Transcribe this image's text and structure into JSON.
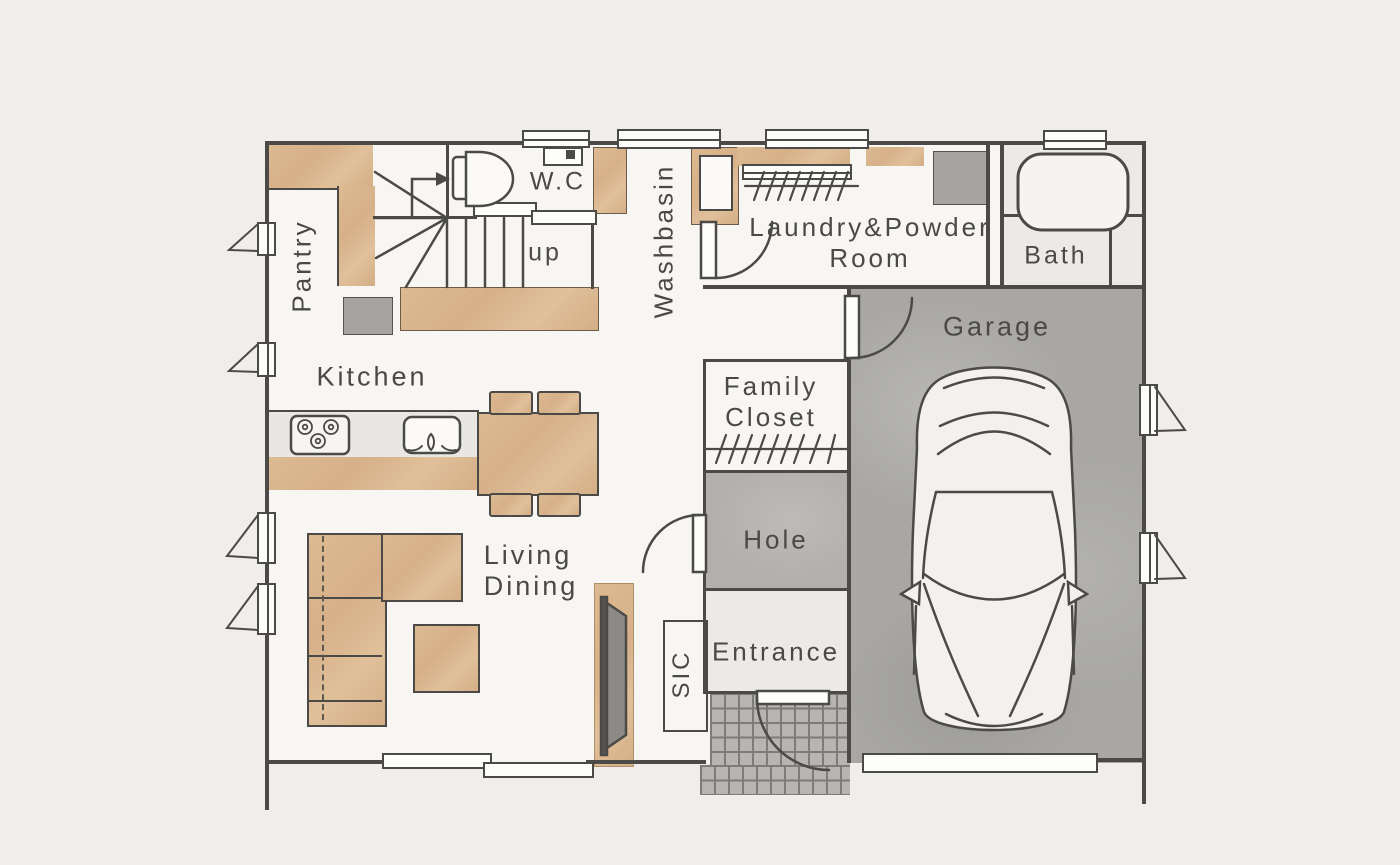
{
  "meta": {
    "type": "architectural-floor-plan",
    "style": "japanese-house-first-floor"
  },
  "labels": {
    "pantry": "Pantry",
    "wc": "W.C",
    "up": "up",
    "washbasin": "Washbasin",
    "laundry_line1": "Laundry&Powder",
    "laundry_line2": "Room",
    "bath": "Bath",
    "kitchen": "Kitchen",
    "garage": "Garage",
    "family_line1": "Family",
    "family_line2": "Closet",
    "hole": "Hole",
    "living_line1": "Living",
    "living_line2": "Dining",
    "sic": "SIC",
    "entrance": "Entrance"
  },
  "colors": {
    "background": "#efeeec",
    "floor": "#f7f6f3",
    "wood": "#d9b68d",
    "wall_line": "#4b4a47",
    "text": "#4a4946",
    "garage_floor": "#a8a7a3",
    "hole_floor": "#b2b0ad",
    "tile_floor": "#b6b5b2",
    "appliance_gray": "#a5a4a1",
    "bath_floor": "#eceae7"
  }
}
